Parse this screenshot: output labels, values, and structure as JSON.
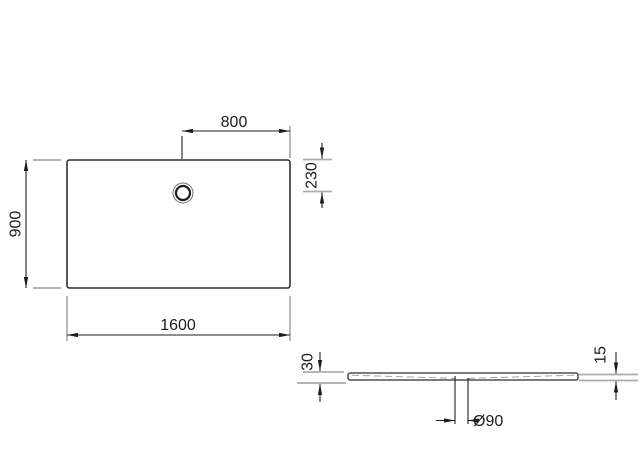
{
  "drawing": {
    "top_view": {
      "width_label": "1600",
      "depth_label": "900",
      "drain_offset_x_label": "800",
      "drain_offset_y_label": "230"
    },
    "side_view": {
      "height_left_label": "30",
      "height_right_label": "15",
      "drain_diameter_label": "Ø90"
    },
    "colors": {
      "object_line": "#2e2e2e",
      "dimension_line": "#1f1f1f",
      "extension_line": "#ababab",
      "text": "#1c1c1c",
      "background": "#ffffff"
    }
  }
}
